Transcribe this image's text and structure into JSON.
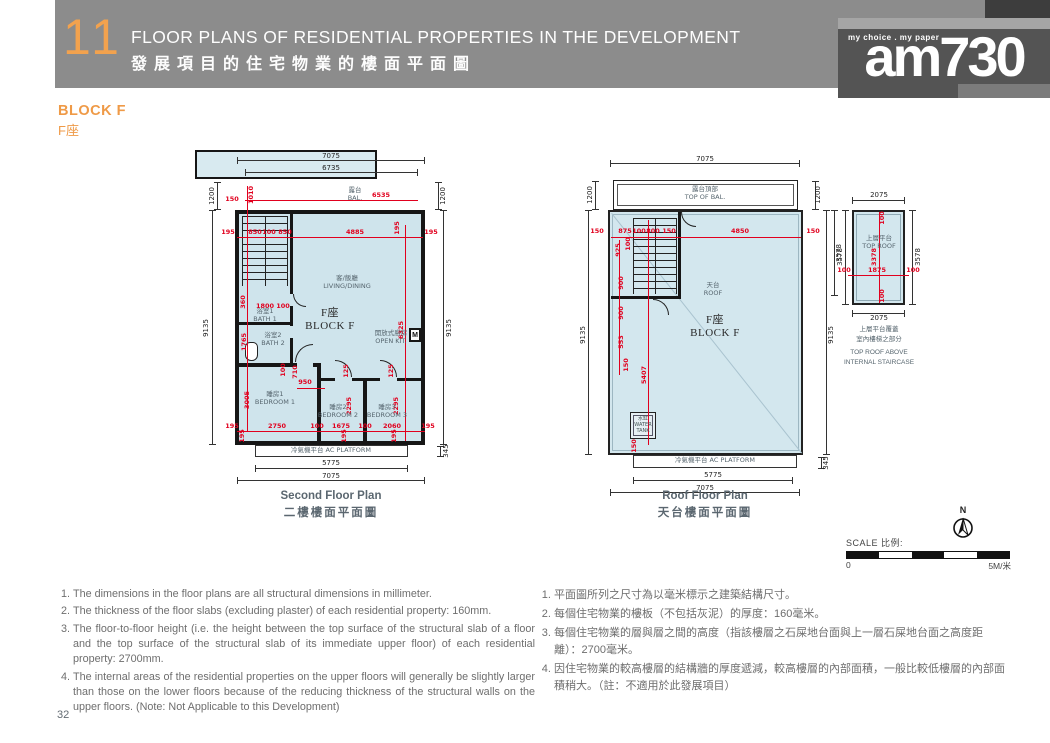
{
  "header": {
    "chapter": "11",
    "title_en": "FLOOR PLANS OF RESIDENTIAL PROPERTIES IN THE DEVELOPMENT",
    "title_zh": "發展項目的住宅物業的樓面平面圖",
    "logo": {
      "tagline": "my choice . my paper",
      "name": "am730"
    }
  },
  "section": {
    "block_en": "BLOCK F",
    "block_zh": "F座"
  },
  "plans": {
    "second": {
      "caption_en": "Second Floor Plan",
      "caption_zh": "二樓樓面平面圖",
      "texts": [
        {
          "t": "7075",
          "x": 136,
          "y": 6
        },
        {
          "t": "6735",
          "x": 136,
          "y": 18
        },
        {
          "t": "1200",
          "x": 17,
          "y": 46,
          "r": 1
        },
        {
          "t": "1200",
          "x": 248,
          "y": 46,
          "r": 1
        },
        {
          "t": "9135",
          "x": 11,
          "y": 178,
          "r": 1
        },
        {
          "t": "9135",
          "x": 254,
          "y": 178,
          "r": 1
        },
        {
          "t": "5775",
          "x": 136,
          "y": 313
        },
        {
          "t": "7075",
          "x": 136,
          "y": 326
        },
        {
          "t": "345",
          "x": 251,
          "y": 301,
          "r": 1
        },
        {
          "t": "150",
          "x": 37,
          "y": 50,
          "c": "red"
        },
        {
          "t": "6535",
          "x": 186,
          "y": 46,
          "c": "red"
        },
        {
          "t": "1010",
          "x": 57,
          "y": 45,
          "r": 1,
          "c": "red"
        },
        {
          "t": "195",
          "x": 33,
          "y": 83,
          "c": "red"
        },
        {
          "t": "850",
          "x": 60,
          "y": 83,
          "c": "red"
        },
        {
          "t": "100",
          "x": 74,
          "y": 83,
          "c": "red"
        },
        {
          "t": "850",
          "x": 90,
          "y": 83,
          "c": "red"
        },
        {
          "t": "4885",
          "x": 160,
          "y": 83,
          "c": "red"
        },
        {
          "t": "195",
          "x": 203,
          "y": 78,
          "r": 1,
          "c": "red"
        },
        {
          "t": "195",
          "x": 236,
          "y": 83,
          "c": "red"
        },
        {
          "t": "6325",
          "x": 207,
          "y": 180,
          "r": 1,
          "c": "red"
        },
        {
          "t": "360",
          "x": 49,
          "y": 152,
          "r": 1,
          "c": "red"
        },
        {
          "t": "1800",
          "x": 70,
          "y": 157,
          "c": "red"
        },
        {
          "t": "100",
          "x": 88,
          "y": 157,
          "c": "red"
        },
        {
          "t": "1765",
          "x": 50,
          "y": 192,
          "r": 1,
          "c": "red"
        },
        {
          "t": "100",
          "x": 89,
          "y": 220,
          "r": 1,
          "c": "red"
        },
        {
          "t": "710",
          "x": 101,
          "y": 222,
          "r": 1,
          "c": "red"
        },
        {
          "t": "950",
          "x": 110,
          "y": 233,
          "c": "red"
        },
        {
          "t": "3005",
          "x": 53,
          "y": 250,
          "r": 1,
          "c": "red"
        },
        {
          "t": "125",
          "x": 152,
          "y": 221,
          "r": 1,
          "c": "red"
        },
        {
          "t": "125",
          "x": 197,
          "y": 221,
          "r": 1,
          "c": "red"
        },
        {
          "t": "2295",
          "x": 155,
          "y": 256,
          "r": 1,
          "c": "red"
        },
        {
          "t": "2295",
          "x": 202,
          "y": 256,
          "r": 1,
          "c": "red"
        },
        {
          "t": "195",
          "x": 37,
          "y": 277,
          "c": "red"
        },
        {
          "t": "2750",
          "x": 82,
          "y": 277,
          "c": "red"
        },
        {
          "t": "100",
          "x": 122,
          "y": 277,
          "c": "red"
        },
        {
          "t": "1675",
          "x": 146,
          "y": 277,
          "c": "red"
        },
        {
          "t": "100",
          "x": 170,
          "y": 277,
          "c": "red"
        },
        {
          "t": "2060",
          "x": 197,
          "y": 277,
          "c": "red"
        },
        {
          "t": "195",
          "x": 233,
          "y": 277,
          "c": "red"
        },
        {
          "t": "195",
          "x": 48,
          "y": 286,
          "r": 1,
          "c": "red"
        },
        {
          "t": "195",
          "x": 150,
          "y": 286,
          "r": 1,
          "c": "red"
        },
        {
          "t": "195",
          "x": 200,
          "y": 286,
          "r": 1,
          "c": "red"
        },
        {
          "t": "露台\nBAL.",
          "x": 160,
          "y": 45,
          "c": "lbl"
        },
        {
          "t": "客/飯廳\nLIVING/DINING",
          "x": 152,
          "y": 133,
          "c": "lbl"
        },
        {
          "t": "開放式廚房\nOPEN KIT.",
          "x": 196,
          "y": 188,
          "c": "lbl"
        },
        {
          "t": "浴室1\nBATH 1",
          "x": 70,
          "y": 166,
          "c": "lbl"
        },
        {
          "t": "浴室2\nBATH 2",
          "x": 78,
          "y": 190,
          "c": "lbl"
        },
        {
          "t": "睡房1\nBEDROOM 1",
          "x": 80,
          "y": 249,
          "c": "lbl"
        },
        {
          "t": "睡房2\nBEDROOM 2",
          "x": 143,
          "y": 262,
          "c": "lbl"
        },
        {
          "t": "睡房3\nBEDROOM 3",
          "x": 192,
          "y": 262,
          "c": "lbl"
        },
        {
          "t": "冷氣機平台 AC PLATFORM",
          "x": 136,
          "y": 301,
          "c": "lbl"
        },
        {
          "t": "F座\nBLOCK F",
          "x": 135,
          "y": 170,
          "c": "big"
        }
      ]
    },
    "roof": {
      "caption_en": "Roof Floor Plan",
      "caption_zh": "天台樓面平面圖",
      "texts": [
        {
          "t": "7075",
          "x": 130,
          "y": 9
        },
        {
          "t": "1200",
          "x": 15,
          "y": 45,
          "r": 1
        },
        {
          "t": "1200",
          "x": 243,
          "y": 45,
          "r": 1
        },
        {
          "t": "9135",
          "x": 8,
          "y": 185,
          "r": 1
        },
        {
          "t": "9135",
          "x": 256,
          "y": 185,
          "r": 1
        },
        {
          "t": "3578",
          "x": 264,
          "y": 103,
          "r": 1
        },
        {
          "t": "5775",
          "x": 138,
          "y": 325
        },
        {
          "t": "7075",
          "x": 130,
          "y": 338
        },
        {
          "t": "345",
          "x": 251,
          "y": 313,
          "r": 1
        },
        {
          "t": "150",
          "x": 22,
          "y": 82,
          "c": "red"
        },
        {
          "t": "875",
          "x": 50,
          "y": 82,
          "c": "red"
        },
        {
          "t": "100",
          "x": 64,
          "y": 82,
          "c": "red"
        },
        {
          "t": "800",
          "x": 78,
          "y": 82,
          "c": "red"
        },
        {
          "t": "150",
          "x": 94,
          "y": 82,
          "c": "red"
        },
        {
          "t": "4850",
          "x": 165,
          "y": 82,
          "c": "red"
        },
        {
          "t": "150",
          "x": 238,
          "y": 82,
          "c": "red"
        },
        {
          "t": "925",
          "x": 44,
          "y": 100,
          "r": 1,
          "c": "red"
        },
        {
          "t": "100",
          "x": 54,
          "y": 94,
          "r": 1,
          "c": "red"
        },
        {
          "t": "900",
          "x": 47,
          "y": 133,
          "r": 1,
          "c": "red"
        },
        {
          "t": "900",
          "x": 47,
          "y": 163,
          "r": 1,
          "c": "red"
        },
        {
          "t": "553",
          "x": 47,
          "y": 192,
          "r": 1,
          "c": "red"
        },
        {
          "t": "150",
          "x": 52,
          "y": 215,
          "r": 1,
          "c": "red"
        },
        {
          "t": "5407",
          "x": 70,
          "y": 225,
          "r": 1,
          "c": "red"
        },
        {
          "t": "150",
          "x": 60,
          "y": 296,
          "r": 1,
          "c": "red"
        },
        {
          "t": "露台頂部\nTOP OF BAL.",
          "x": 130,
          "y": 44,
          "c": "lbl"
        },
        {
          "t": "天台\nROOF",
          "x": 138,
          "y": 140,
          "c": "lbl"
        },
        {
          "t": "水缸\nWATER\nTANK",
          "x": 68,
          "y": 275,
          "c": "tiny"
        },
        {
          "t": "冷氣機平台 AC PLATFORM",
          "x": 140,
          "y": 311,
          "c": "lbl"
        },
        {
          "t": "F座\nBLOCK F",
          "x": 140,
          "y": 177,
          "c": "big"
        }
      ]
    },
    "top_roof": {
      "caption_zh": "上層平台覆蓋\n室內樓梯之部分",
      "caption_en": "TOP ROOF ABOVE\nINTERNAL STAIRCASE",
      "texts": [
        {
          "t": "2075",
          "x": 44,
          "y": 10
        },
        {
          "t": "2075",
          "x": 44,
          "y": 133
        },
        {
          "t": "3578",
          "x": 5,
          "y": 72,
          "r": 1
        },
        {
          "t": "3578",
          "x": 83,
          "y": 72,
          "r": 1
        },
        {
          "t": "100",
          "x": 9,
          "y": 86,
          "c": "red"
        },
        {
          "t": "1875",
          "x": 42,
          "y": 86,
          "c": "red"
        },
        {
          "t": "100",
          "x": 78,
          "y": 86,
          "c": "red"
        },
        {
          "t": "100",
          "x": 48,
          "y": 33,
          "r": 1,
          "c": "red"
        },
        {
          "t": "3378",
          "x": 40,
          "y": 72,
          "r": 1,
          "c": "red"
        },
        {
          "t": "100",
          "x": 48,
          "y": 111,
          "r": 1,
          "c": "red"
        },
        {
          "t": "上層平台\nTOP ROOF",
          "x": 44,
          "y": 58,
          "c": "lbl"
        }
      ]
    }
  },
  "compass": {
    "label": "N"
  },
  "scale": {
    "label": "SCALE 比例:",
    "start": "0",
    "end": "5M/米"
  },
  "notes_en": [
    "The dimensions in the floor plans are all structural dimensions in millimeter.",
    "The thickness of the floor slabs (excluding plaster) of each residential property: 160mm.",
    "The floor-to-floor height (i.e. the height between the top surface of the structural slab of a floor and the top surface of the structural slab of its immediate upper floor) of each residential property: 2700mm.",
    "The internal areas of the residential properties on the upper floors will generally be slightly larger than those on the lower floors because of the reducing thickness of the structural walls on the upper floors. (Note: Not Applicable to this Development)"
  ],
  "notes_zh": [
    "平面圖所列之尺寸為以毫米標示之建築結構尺寸。",
    "每個住宅物業的樓板（不包括灰泥）的厚度：160毫米。",
    "每個住宅物業的層與層之間的高度（指該樓層之石屎地台面與上一層石屎地台面之高度距離）：2700毫米。",
    "因住宅物業的較高樓層的結構牆的厚度遞減，較高樓層的內部面積，一般比較低樓層的內部面積稍大。（註：不適用於此發展項目）"
  ],
  "page_number": "32",
  "colors": {
    "accent_orange": "#ef9a47",
    "header_gray": "#8c8c8c",
    "floor_fill": "#cfe4ec",
    "dim_red": "#e1001e"
  }
}
